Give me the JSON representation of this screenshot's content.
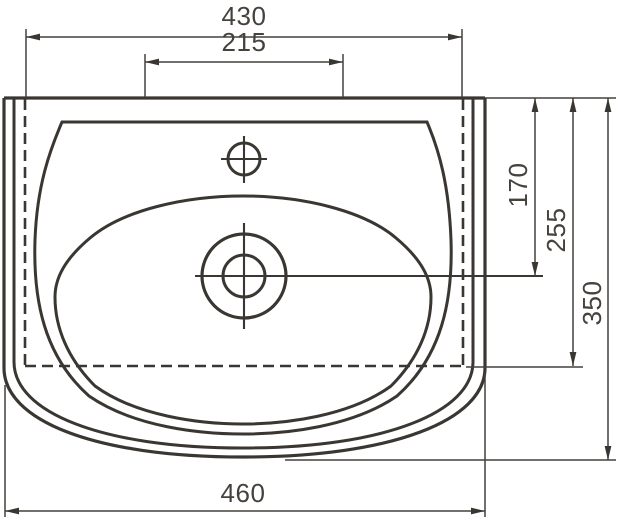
{
  "drawing": {
    "type": "technical-dimension-drawing",
    "subject": "washbasin-top-view",
    "background_color": "#ffffff",
    "line_color": "#3a3632",
    "text_color": "#45413d",
    "dimensions": {
      "top_width": "430",
      "faucet_span": "215",
      "rim_to_drain_center": "170",
      "rim_to_hidden_edge": "255",
      "rim_to_front": "350",
      "overall_width": "460"
    }
  }
}
